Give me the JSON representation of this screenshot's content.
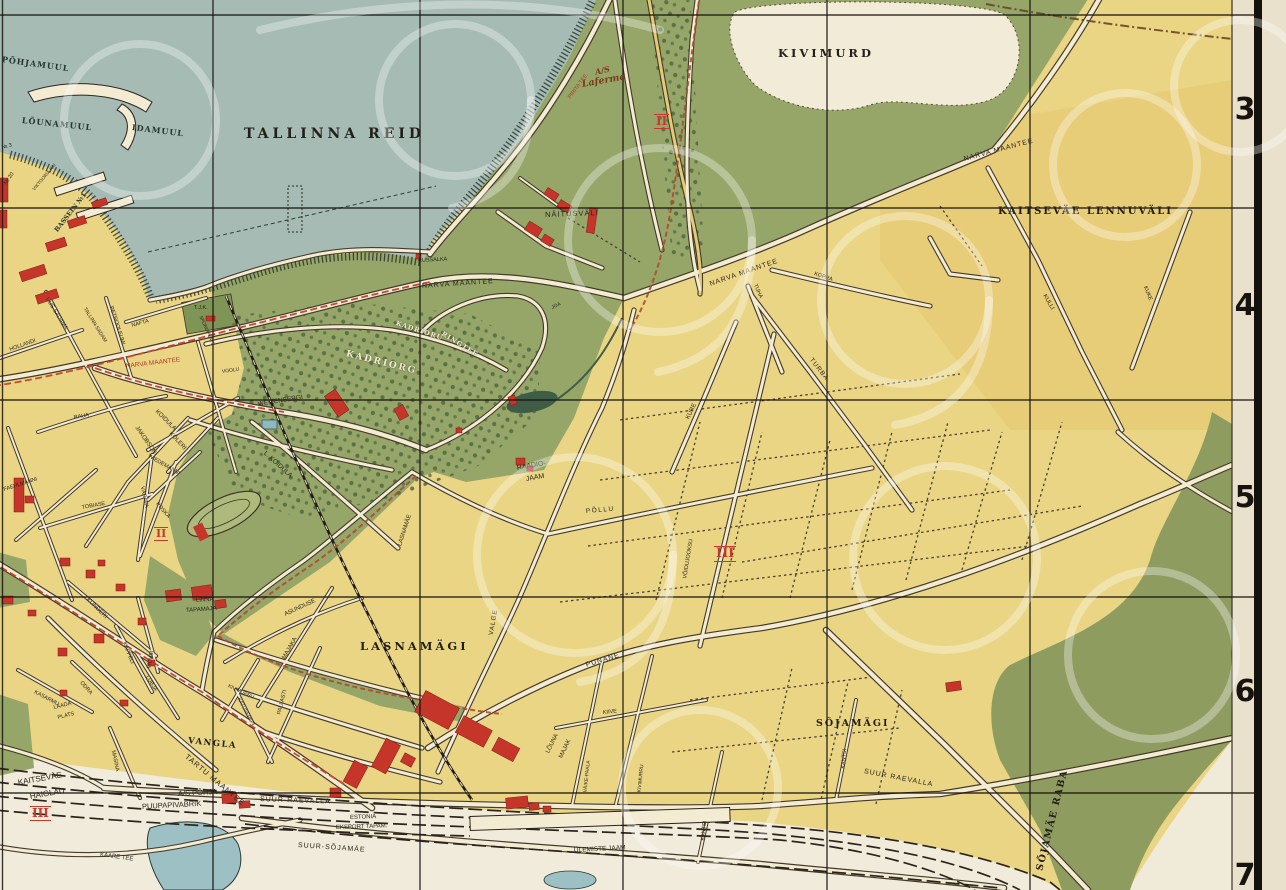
{
  "palette": {
    "land_yellow": "#e9d584",
    "airfield_yellow": "#e7c76f",
    "sea": "#a5bbb4",
    "park_green": "#95a668",
    "tree_green": "#4e6742",
    "bog_olive": "#8e9c60",
    "road_cream": "#f3ebd2",
    "road_casing": "#443a2a",
    "building_red": "#c5352a",
    "tram_red": "#c84836",
    "rail_black": "#241d15",
    "grid_black": "#1a1510",
    "margin_cream": "#e9e1cb",
    "quarry_pale": "#f2ebd8",
    "numeral_red": "#c23b2d"
  },
  "map": {
    "grid_numbers": [
      {
        "t": "3",
        "x": 1234,
        "y": 92
      },
      {
        "t": "4",
        "x": 1234,
        "y": 288
      },
      {
        "t": "5",
        "x": 1234,
        "y": 480
      },
      {
        "t": "6",
        "x": 1234,
        "y": 674
      },
      {
        "t": "7",
        "x": 1234,
        "y": 858
      }
    ],
    "numerals": [
      {
        "t": "II",
        "x": 654,
        "y": 114,
        "s": 12
      },
      {
        "t": "II",
        "x": 154,
        "y": 527,
        "s": 11
      },
      {
        "t": "III",
        "x": 714,
        "y": 546,
        "s": 13
      },
      {
        "t": "III",
        "x": 30,
        "y": 806,
        "s": 12
      }
    ],
    "labels": [
      {
        "t": "TALLINNA REID",
        "x": 244,
        "y": 127,
        "s": 14,
        "ls": 4,
        "cls": "area"
      },
      {
        "t": "KIVIMURD",
        "x": 778,
        "y": 48,
        "s": 11.5,
        "ls": 3,
        "cls": "area"
      },
      {
        "t": "KAITSEVÄE LENNUVÄLI",
        "x": 998,
        "y": 207,
        "s": 10,
        "ls": 2,
        "cls": "area"
      },
      {
        "t": "LASNAMÄGI",
        "x": 360,
        "y": 641,
        "s": 11.5,
        "ls": 3,
        "cls": "area"
      },
      {
        "t": "SÕJAMÄGI",
        "x": 816,
        "y": 719,
        "s": 9.5,
        "ls": 2,
        "cls": "area"
      },
      {
        "t": "SÕJAMÄE RABA",
        "x": 1040,
        "y": 866,
        "r": -76,
        "s": 9.5,
        "ls": 1.5,
        "cls": "area"
      },
      {
        "t": "VANGLA",
        "x": 188,
        "y": 737,
        "r": 6,
        "s": 8.5,
        "ls": 1.5,
        "cls": "area"
      },
      {
        "t": "KADRIORG",
        "x": 346,
        "y": 350,
        "r": 14,
        "s": 9,
        "ls": 2,
        "cls": "cream"
      },
      {
        "t": "KADRIORU",
        "x": 396,
        "y": 320,
        "r": 18,
        "s": 6.5,
        "ls": 1,
        "cls": "cream"
      },
      {
        "t": "RINGTEE",
        "x": 442,
        "y": 330,
        "r": 32,
        "s": 6.5,
        "ls": 1,
        "cls": "cream"
      },
      {
        "t": "NÄITUSVÄLI",
        "x": 545,
        "y": 211,
        "r": -2,
        "s": 7.5,
        "ls": 1
      },
      {
        "t": "RUSSALKA",
        "x": 418,
        "y": 259,
        "r": -3,
        "s": 5.5
      },
      {
        "t": "A/S",
        "x": 595,
        "y": 68,
        "r": -14,
        "s": 8,
        "cls": "script"
      },
      {
        "t": "Laferme",
        "x": 582,
        "y": 80,
        "r": -10,
        "s": 9.5,
        "cls": "script"
      },
      {
        "t": "PIRITA TEE",
        "x": 570,
        "y": 96,
        "r": -53,
        "s": 5.5,
        "cls": "redlbl"
      },
      {
        "t": "NARVA MAANTEE",
        "x": 126,
        "y": 364,
        "r": -7,
        "s": 6.5,
        "cls": "redlbl"
      },
      {
        "t": "NARVA MAANTEE",
        "x": 422,
        "y": 283,
        "r": -4,
        "s": 7,
        "ls": 1
      },
      {
        "t": "NARVA MAANTEE",
        "x": 710,
        "y": 281,
        "r": -19,
        "s": 7,
        "ls": 1
      },
      {
        "t": "NARVA MAANTEE",
        "x": 964,
        "y": 156,
        "r": -15,
        "s": 7,
        "ls": 1
      },
      {
        "t": "RAADIO-",
        "x": 517,
        "y": 465,
        "r": -10,
        "s": 7
      },
      {
        "t": "JAAM",
        "x": 526,
        "y": 476,
        "r": -10,
        "s": 7
      },
      {
        "t": "PÕLLU",
        "x": 586,
        "y": 509,
        "r": -5,
        "s": 6.5,
        "ls": 1.5
      },
      {
        "t": "PUNANE",
        "x": 586,
        "y": 662,
        "r": -17,
        "s": 7,
        "ls": 1
      },
      {
        "t": "VALGE",
        "x": 492,
        "y": 632,
        "r": -80,
        "s": 6.5,
        "ls": 1
      },
      {
        "t": "TURBA",
        "x": 810,
        "y": 356,
        "r": 52,
        "s": 6.5,
        "ls": 1
      },
      {
        "t": "KURE",
        "x": 688,
        "y": 416,
        "r": -64,
        "s": 6
      },
      {
        "t": "TUHA",
        "x": 754,
        "y": 282,
        "r": 66,
        "s": 5.5
      },
      {
        "t": "KOPRA",
        "x": 814,
        "y": 272,
        "r": 18,
        "s": 5.5
      },
      {
        "t": "KULLI",
        "x": 1044,
        "y": 292,
        "r": 60,
        "s": 6
      },
      {
        "t": "KUKE",
        "x": 1144,
        "y": 284,
        "r": 68,
        "s": 5.5
      },
      {
        "t": "VÕIDUJOOKSU",
        "x": 686,
        "y": 576,
        "r": -81,
        "s": 5.5
      },
      {
        "t": "KIIVE",
        "x": 603,
        "y": 711,
        "r": -6,
        "s": 5.5
      },
      {
        "t": "VÄIKE-PAALA",
        "x": 586,
        "y": 790,
        "r": -84,
        "s": 5
      },
      {
        "t": "KIVIMURRU",
        "x": 640,
        "y": 790,
        "r": -84,
        "s": 5
      },
      {
        "t": "KANTSI",
        "x": 704,
        "y": 838,
        "r": -84,
        "s": 5.5
      },
      {
        "t": "KANTSI",
        "x": 844,
        "y": 766,
        "r": -84,
        "s": 5.5
      },
      {
        "t": "SUUR-RAEVALLA",
        "x": 260,
        "y": 796,
        "r": 2,
        "s": 7,
        "ls": 1
      },
      {
        "t": "SUUR RAEVALLA",
        "x": 864,
        "y": 768,
        "r": 11,
        "s": 7,
        "ls": 1
      },
      {
        "t": "SUUR-SÕJAMÄE",
        "x": 298,
        "y": 842,
        "r": 4,
        "s": 7,
        "ls": 1
      },
      {
        "t": "ÜLEMISTE JAAM",
        "x": 574,
        "y": 848,
        "r": -3,
        "s": 6.5
      },
      {
        "t": "LÕUNA",
        "x": 548,
        "y": 750,
        "r": -64,
        "s": 6
      },
      {
        "t": "MAJAK",
        "x": 561,
        "y": 755,
        "r": -64,
        "s": 6
      },
      {
        "t": "TARTU MAANTEE",
        "x": 186,
        "y": 752,
        "r": 40,
        "s": 7.5,
        "ls": 1
      },
      {
        "t": "KAITSEVÄE",
        "x": 18,
        "y": 779,
        "r": -10,
        "s": 8
      },
      {
        "t": "HAIGLAD",
        "x": 30,
        "y": 793,
        "r": -10,
        "s": 8
      },
      {
        "t": "A/S PÕHJA",
        "x": 178,
        "y": 790,
        "r": -3,
        "s": 7.5
      },
      {
        "t": "PUUPAPIVABRIK",
        "x": 142,
        "y": 803,
        "r": -3,
        "s": 7.5
      },
      {
        "t": "ESTONIA",
        "x": 350,
        "y": 815,
        "r": -2,
        "s": 6
      },
      {
        "t": "EKSPORT TAPAM.",
        "x": 336,
        "y": 825,
        "r": -2,
        "s": 6
      },
      {
        "t": "LINNA",
        "x": 196,
        "y": 598,
        "r": -4,
        "s": 6
      },
      {
        "t": "TAPAMAJA",
        "x": 186,
        "y": 608,
        "r": -4,
        "s": 6
      },
      {
        "t": "LAADA",
        "x": 54,
        "y": 706,
        "r": -14,
        "s": 5.5
      },
      {
        "t": "PLATS",
        "x": 58,
        "y": 716,
        "r": -14,
        "s": 5.5
      },
      {
        "t": "KAARE TEE",
        "x": 100,
        "y": 852,
        "r": 8,
        "s": 6
      },
      {
        "t": "WEIZENBERGI",
        "x": 258,
        "y": 402,
        "r": -9,
        "s": 6.5
      },
      {
        "t": "L. KOIDULA",
        "x": 264,
        "y": 450,
        "r": 42,
        "s": 6.5
      },
      {
        "t": "KOIDULA",
        "x": 156,
        "y": 408,
        "r": 45,
        "s": 6
      },
      {
        "t": "KÖLERI",
        "x": 170,
        "y": 430,
        "r": 48,
        "s": 6
      },
      {
        "t": "JAKOBSONI",
        "x": 136,
        "y": 424,
        "r": 55,
        "s": 6
      },
      {
        "t": "WIEDEMANNI",
        "x": 148,
        "y": 454,
        "r": 30,
        "s": 5.5
      },
      {
        "t": "VÄRAVA",
        "x": 141,
        "y": 484,
        "r": 78,
        "s": 5.5
      },
      {
        "t": "POSKA",
        "x": 156,
        "y": 501,
        "r": 50,
        "s": 5.5
      },
      {
        "t": "TOBIASE",
        "x": 82,
        "y": 506,
        "r": -10,
        "s": 5.5
      },
      {
        "t": "FAEHLMANNI",
        "x": 4,
        "y": 488,
        "r": -18,
        "s": 5.5
      },
      {
        "t": "HOLLANDI",
        "x": 10,
        "y": 348,
        "r": -20,
        "s": 5.5
      },
      {
        "t": "UUS-SADAMA",
        "x": 46,
        "y": 296,
        "r": 58,
        "s": 5.5
      },
      {
        "t": "TALLINN-SADAM",
        "x": 84,
        "y": 306,
        "r": 58,
        "s": 5
      },
      {
        "t": "PETROOLEUMI",
        "x": 110,
        "y": 304,
        "r": 72,
        "s": 5.5
      },
      {
        "t": "NAFTA",
        "x": 132,
        "y": 324,
        "r": -16,
        "s": 5.5
      },
      {
        "t": "VOOLU",
        "x": 222,
        "y": 370,
        "r": -8,
        "s": 5
      },
      {
        "t": "RAUA",
        "x": 74,
        "y": 416,
        "r": -10,
        "s": 5.5
      },
      {
        "t": "T.J.K.",
        "x": 194,
        "y": 306,
        "s": 5.5
      },
      {
        "t": "SPORDIPLATS",
        "x": 200,
        "y": 314,
        "r": 66,
        "s": 4.6
      },
      {
        "t": "KUNDERI",
        "x": 87,
        "y": 596,
        "r": 45,
        "s": 6
      },
      {
        "t": "KAPPELI",
        "x": 123,
        "y": 640,
        "r": 68,
        "s": 5.5
      },
      {
        "t": "VILMSI",
        "x": 150,
        "y": 666,
        "r": -80,
        "s": 5.5
      },
      {
        "t": "LUBJA",
        "x": 146,
        "y": 674,
        "r": 58,
        "s": 5.5
      },
      {
        "t": "ODRA",
        "x": 80,
        "y": 680,
        "r": 48,
        "s": 5.5
      },
      {
        "t": "KASARMU",
        "x": 34,
        "y": 690,
        "r": 28,
        "s": 5.5
      },
      {
        "t": "MASINA",
        "x": 112,
        "y": 748,
        "r": 78,
        "s": 5.5
      },
      {
        "t": "KATUSEPAPI",
        "x": 238,
        "y": 696,
        "r": 62,
        "s": 5
      },
      {
        "t": "KIVIMURRU",
        "x": 228,
        "y": 684,
        "r": 25,
        "s": 5
      },
      {
        "t": "PALLASTI",
        "x": 280,
        "y": 712,
        "r": -76,
        "s": 5.5
      },
      {
        "t": "MAJAKA",
        "x": 284,
        "y": 656,
        "r": -60,
        "s": 6
      },
      {
        "t": "ASUNDUSE",
        "x": 285,
        "y": 612,
        "r": -25,
        "s": 6
      },
      {
        "t": "LASNAMÄE",
        "x": 400,
        "y": 543,
        "r": -72,
        "s": 6
      },
      {
        "t": "JOA",
        "x": 552,
        "y": 306,
        "r": -25,
        "s": 5
      },
      {
        "t": "PÕHJAMUUL",
        "x": 2,
        "y": 55,
        "r": 8,
        "s": 8,
        "ls": 1,
        "cls": "area2"
      },
      {
        "t": "LÕUNAMUUL",
        "x": 22,
        "y": 116,
        "r": 6,
        "s": 8,
        "ls": 1,
        "cls": "area2"
      },
      {
        "t": "IDAMUUL",
        "x": 132,
        "y": 123,
        "r": 7,
        "s": 8,
        "ls": 1,
        "cls": "area2"
      },
      {
        "t": "BASSEIN №1",
        "x": 56,
        "y": 228,
        "r": -52,
        "s": 6.5,
        "cls": "area2"
      },
      {
        "t": "VIKTOORIA KAI",
        "x": 34,
        "y": 188,
        "r": -50,
        "s": 4.6
      },
      {
        "t": "№ 3",
        "x": 2,
        "y": 146,
        "r": -15,
        "s": 5.5
      },
      {
        "t": "№ 20",
        "x": 6,
        "y": 182,
        "r": -55,
        "s": 5.5
      }
    ]
  }
}
